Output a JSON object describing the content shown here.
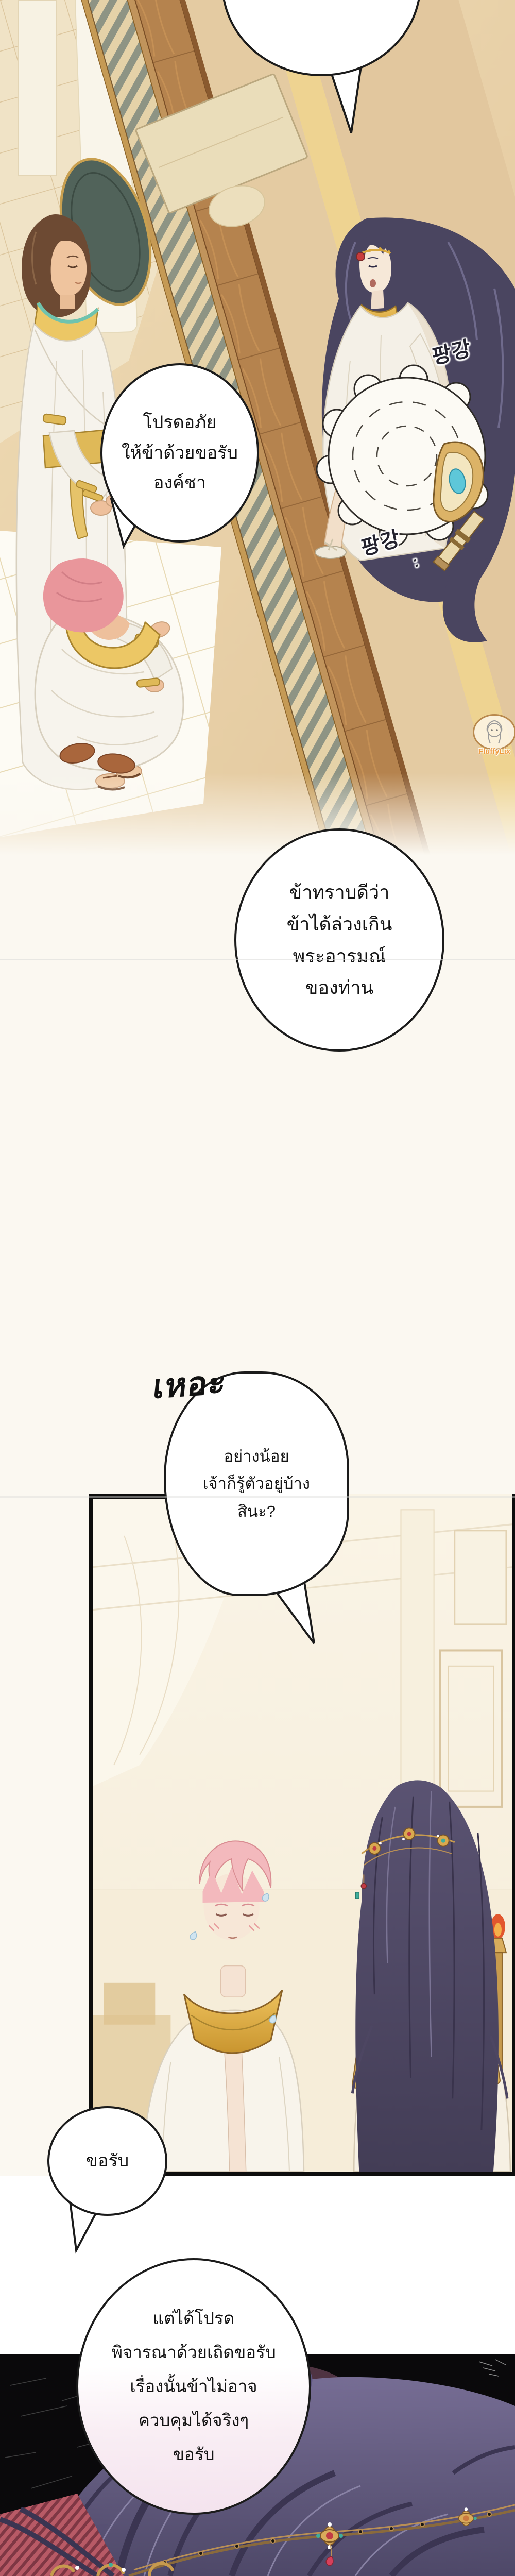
{
  "dialogue": {
    "bubble1": {
      "speaker_note": "pink-haired servant",
      "text": "โปรดอภัย\nให้ข้าด้วยขอรับ\nองค์ชา"
    },
    "bubble2": {
      "speaker_note": "pink-haired servant",
      "text": "ข้าทราบดีว่า\nข้าได้ล่วงเกิน\nพระอารมณ์\nของท่าน"
    },
    "laugh": {
      "text": "เหอะ"
    },
    "bubble3": {
      "speaker_note": "long-haired prince",
      "text": "อย่างน้อย\nเจ้าก็รู้ตัวอยู่บ้าง\nสินะ?"
    },
    "bubble4": {
      "text": "ขอรับ"
    },
    "bubble5": {
      "text": "แต่ได้โปรด\nพิจารณาด้วยเถิดขอรับ\nเรื่องนั้นข้าไม่อาจ\nควบคุมได้จริงๆ\nขอรับ"
    }
  },
  "sfx": {
    "fan1": {
      "text": "팡강"
    },
    "fan2": {
      "text": "팡강",
      "suffix": ":"
    }
  },
  "watermark": {
    "label": "FluffyLix"
  },
  "colors": {
    "page_cream": "#fbf8f1",
    "floor_tan": "#e3c89e",
    "floor_yellow_stripe": "#eed391",
    "wood_ledge": "#b5834e",
    "lattice_olive": "#8e9484",
    "gold": "#d9a93f",
    "collar_teal": "#6fc3ae",
    "teal_sash": "#3f808e",
    "fan_gem_cyan": "#5ec7d9",
    "pendant_red": "#c13b45",
    "prince_hair": "#4a4560",
    "servant_hair_pink": "#e9969b",
    "closeup_hair_purple": "#6e6590",
    "blush_pink": "#e8a0a0",
    "panel_border": "#0d0d0d",
    "dark_panel_bg": "#0a090b",
    "magenta_glow": "#c9679c",
    "bubble_pink_tint": "#f4e3ee",
    "sfx_ink": "#23222e",
    "watermark_orange": "#ef9b3f"
  }
}
